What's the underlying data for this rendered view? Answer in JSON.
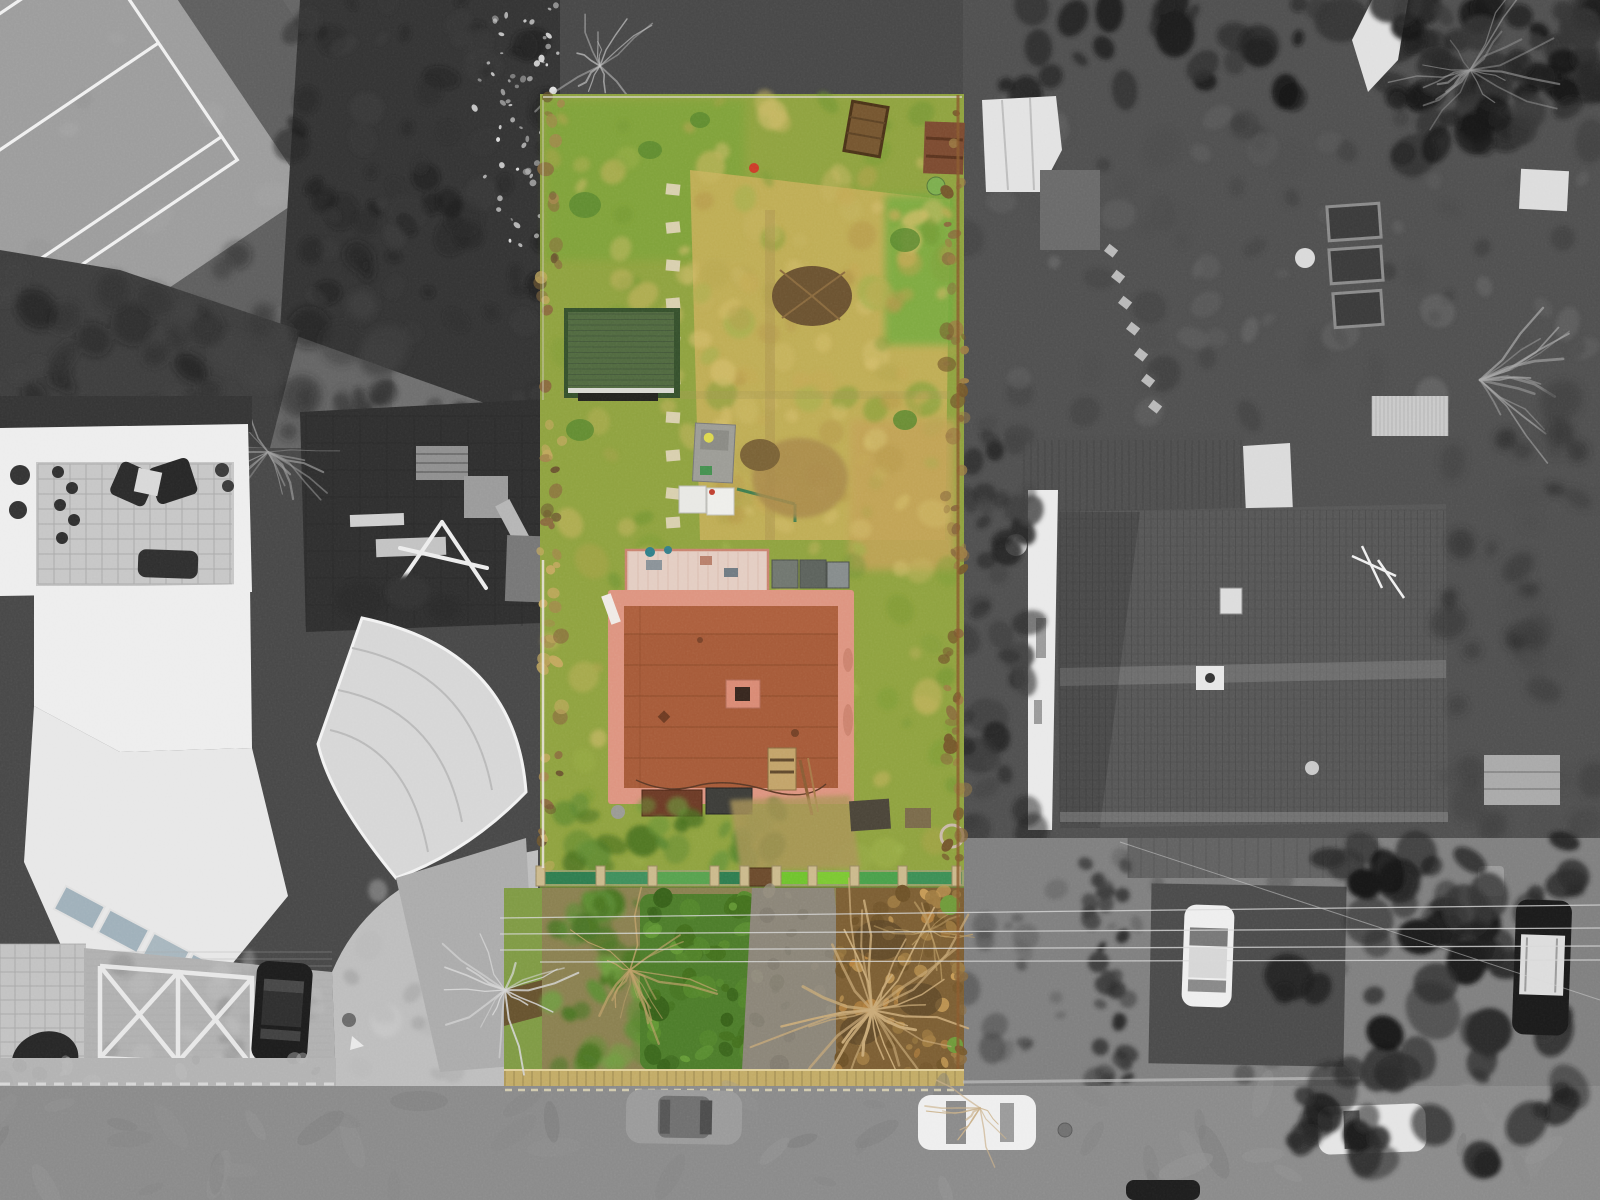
{
  "scene": {
    "type": "aerial-drone-photograph",
    "description": "Top-down aerial photo of a residential plot highlighted in colour while the surrounding neighbourhood is desaturated black-and-white",
    "regions": {
      "tennis_court": "tennis court, top left, grayscale",
      "gray_path": "footpath strip left of the parcel",
      "playground": "playground with dark rubber surface and swing frame",
      "left_building": "white modern apartment building with roof terrace",
      "canopy": "curved fan-shaped white canopy roof",
      "forecourt": "brick forecourt with white X parking markings and black car",
      "highlighted_parcel": "colour-highlighted garden parcel with lawn, shed and flat-roof house",
      "garden_shed": "green-roofed garden shed",
      "flat_roof_house": "terracotta flat-roof house with pink parapet and chimney",
      "green_fence": "green garden fence crossing the parcel",
      "front_garden": "front garden with hedge, bare trees and path",
      "neighbour_roof": "large grey tiled hipped roof, right side",
      "street": "street along the bottom with parked cars",
      "side_street": "right-hand street with parked cars and large evergreen tree"
    }
  },
  "palette": {
    "bg": "#474747",
    "ground_gray": "#646464",
    "path_gray": "#6e6e6e",
    "dark_veg": "#343434",
    "court_apron": "#5e5e5e",
    "court_surface": "#9c9c9c",
    "court_line": "#f0f0f0",
    "playground": "#2e2e2e",
    "building_white": "#ededed",
    "terrace_tile": "#c6c6c6",
    "furniture_dark": "#2a2a2a",
    "brick_pale": "#b0b0b0",
    "marking_white": "#ececec",
    "canopy": "#d6d6d6",
    "walkway": "#ababab",
    "ramp": "#bdbdbd",
    "road": "#8a8a8a",
    "sidewalk": "#b2b2b2",
    "car_gray": "#9a9a9a",
    "car_white": "#eeeeee",
    "car_black": "#1c1c1c",
    "roof_tile_gray": "#565656",
    "gable_white": "#e9e9e9",
    "tarp_white": "#dadada",
    "shed_white_roof": "#e2e2e2",
    "parcel_grass": "#8fa23f",
    "grass_bright": "#7aa338",
    "meadow_dry": "#c4ae58",
    "patch_tan": "#c2a257",
    "shed_roof": "#50693f",
    "shed_eave": "#d9d9d2",
    "house_roof": "#a65a38",
    "roof_border": "#dd9480",
    "chimney": "#d98a74",
    "pergola": "#e3cdc2",
    "rust_panel": "#6c3a26",
    "dark_panel": "#3c3c38",
    "fence_green_dark": "#2e7d4f",
    "fence_green_bright": "#6fc32d",
    "fence_post": "#cbb98c",
    "hedge_front": "#4c7c2a",
    "front_brown": "#7c5e33",
    "front_path": "#8b8578",
    "curb_yellow": "#c2ab66",
    "boundary_brown": "#7a6038",
    "branch_tan": "#c9aa78",
    "red_accent": "#cc3b28",
    "tank_white": "#e8e8e4",
    "stone_path": "#d8cfae",
    "powerline": "#d8d8d8"
  },
  "textures": [
    {
      "target": "tx-topdark",
      "x": 290,
      "y": 0,
      "w": 265,
      "h": 335,
      "n": 70,
      "rmin": 6,
      "rmax": 20,
      "colors": [
        "#262626",
        "#383838",
        "#1c1c1c"
      ],
      "op": 0.5,
      "seed": 11
    },
    {
      "target": "tx-speckwhite",
      "x": 468,
      "y": 0,
      "w": 92,
      "h": 250,
      "n": 60,
      "rmin": 1.5,
      "rmax": 4,
      "colors": [
        "#d2d2d2",
        "#e6e6e6",
        "#bfbfbf"
      ],
      "op": 0.75,
      "seed": 12
    },
    {
      "target": "tx-graypath",
      "x": 392,
      "y": 0,
      "w": 160,
      "h": 436,
      "n": 45,
      "rmin": 4,
      "rmax": 13,
      "colors": [
        "#636363",
        "#7b7b7b",
        "#8c8c8c"
      ],
      "op": 0.5,
      "seed": 13
    },
    {
      "target": "tx-leftdark",
      "x": 0,
      "y": 255,
      "w": 400,
      "h": 185,
      "n": 55,
      "rmin": 8,
      "rmax": 22,
      "colors": [
        "#2c2c2c",
        "#404040",
        "#1f1f1f"
      ],
      "op": 0.55,
      "seed": 14
    },
    {
      "target": "tx-treesoverplay",
      "x": 300,
      "y": 392,
      "w": 270,
      "h": 62,
      "n": 25,
      "rmin": 6,
      "rmax": 16,
      "colors": [
        "#2a2a2a",
        "#3c3c3c"
      ],
      "op": 0.6,
      "seed": 15
    },
    {
      "target": "tx-court",
      "x": -240,
      "y": -160,
      "w": 520,
      "h": 380,
      "n": 25,
      "rmin": 8,
      "rmax": 18,
      "colors": [
        "#8f8f8f",
        "#a8a8a8"
      ],
      "op": 0.3,
      "seed": 16
    },
    {
      "target": "tx-forecourt",
      "x": 90,
      "y": 955,
      "w": 235,
      "h": 125,
      "n": 30,
      "rmin": 6,
      "rmax": 14,
      "colors": [
        "#bcbcbc",
        "#9f9f9f",
        "#8f8f8f"
      ],
      "op": 0.5,
      "seed": 17
    },
    {
      "target": "tx-ramp",
      "x": 340,
      "y": 860,
      "w": 180,
      "h": 220,
      "n": 25,
      "rmin": 6,
      "rmax": 16,
      "colors": [
        "#b5b5b5",
        "#c8c8c8",
        "#a0a0a0"
      ],
      "op": 0.5,
      "seed": 18
    },
    {
      "target": "tx-sidewalkbl",
      "x": 0,
      "y": 1058,
      "w": 340,
      "h": 26,
      "n": 12,
      "rmin": 4,
      "rmax": 10,
      "colors": [
        "#bababa",
        "#a8a8a8"
      ],
      "op": 0.5,
      "seed": 19
    },
    {
      "target": "tx-parcelgrass",
      "x": 548,
      "y": 100,
      "w": 410,
      "h": 760,
      "n": 170,
      "rmin": 5,
      "rmax": 17,
      "colors": [
        "#9db04a",
        "#7d9c36",
        "#c6b45f",
        "#b2a24c",
        "#6e9330",
        "#d0bc6a"
      ],
      "op": 0.5,
      "seed": 21
    },
    {
      "target": "tx-dryextra",
      "x": 700,
      "y": 190,
      "w": 250,
      "h": 340,
      "n": 60,
      "rmin": 6,
      "rmax": 15,
      "colors": [
        "#d2bc68",
        "#c3a954",
        "#b5974a"
      ],
      "op": 0.6,
      "seed": 22
    },
    {
      "target": "tx-lowershrub",
      "x": 560,
      "y": 800,
      "w": 220,
      "h": 80,
      "n": 30,
      "rmin": 6,
      "rmax": 16,
      "colors": [
        "#55842e",
        "#6a9438",
        "#47701f"
      ],
      "op": 0.7,
      "seed": 23
    },
    {
      "target": "tx-frontgreen",
      "x": 548,
      "y": 892,
      "w": 100,
      "h": 180,
      "n": 40,
      "rmin": 6,
      "rmax": 16,
      "colors": [
        "#5d8c33",
        "#4a7524",
        "#6f9e3f"
      ],
      "op": 0.8,
      "seed": 24
    },
    {
      "target": "tx-hedgecol",
      "x": 642,
      "y": 896,
      "w": 110,
      "h": 172,
      "n": 50,
      "rmin": 4,
      "rmax": 12,
      "colors": [
        "#426f1d",
        "#55882c",
        "#37611a",
        "#649a36"
      ],
      "op": 0.8,
      "seed": 25
    },
    {
      "target": "tx-frontbrown",
      "x": 838,
      "y": 890,
      "w": 122,
      "h": 182,
      "n": 70,
      "rmin": 3,
      "rmax": 8,
      "colors": [
        "#a07c42",
        "#b5823f",
        "#6e5228",
        "#c59a55"
      ],
      "op": 0.8,
      "seed": 26
    },
    {
      "target": "tx-pathfront",
      "x": 748,
      "y": 890,
      "w": 100,
      "h": 182,
      "n": 18,
      "rmin": 4,
      "rmax": 10,
      "colors": [
        "#7f7a6d",
        "#968f80"
      ],
      "op": 0.6,
      "seed": 27
    },
    {
      "target": "tx-leftbound",
      "x": 540,
      "y": 96,
      "w": 22,
      "h": 772,
      "n": 60,
      "rmin": 3,
      "rmax": 8,
      "colors": [
        "#8a6b3e",
        "#a3864c",
        "#c2a85e",
        "#6b5530"
      ],
      "op": 0.8,
      "seed": 28
    },
    {
      "target": "tx-rightbound",
      "x": 944,
      "y": 96,
      "w": 20,
      "h": 975,
      "n": 70,
      "rmin": 3,
      "rmax": 8,
      "colors": [
        "#8a6b3e",
        "#9c7c44",
        "#75582c"
      ],
      "op": 0.8,
      "seed": 29
    },
    {
      "target": "tx-hedgerowtop",
      "x": 963,
      "y": 0,
      "w": 637,
      "h": 100,
      "n": 60,
      "rmin": 8,
      "rmax": 24,
      "colors": [
        "#1e1e1e",
        "#2d2d2d",
        "#141414"
      ],
      "op": 0.8,
      "seed": 31
    },
    {
      "target": "tx-rightground",
      "x": 963,
      "y": 100,
      "w": 630,
      "h": 325,
      "n": 90,
      "rmin": 6,
      "rmax": 18,
      "colors": [
        "#4b4b4b",
        "#5d5d5d",
        "#3b3b3b",
        "#6a6a6a"
      ],
      "op": 0.55,
      "seed": 32
    },
    {
      "target": "tx-trcorner",
      "x": 1380,
      "y": 0,
      "w": 220,
      "h": 170,
      "n": 40,
      "rmin": 8,
      "rmax": 22,
      "colors": [
        "#222222",
        "#333333",
        "#181818"
      ],
      "op": 0.7,
      "seed": 33
    },
    {
      "target": "tx-bushesmid",
      "x": 963,
      "y": 420,
      "w": 70,
      "h": 430,
      "n": 40,
      "rmin": 8,
      "rmax": 18,
      "colors": [
        "#303030",
        "#414141",
        "#232323"
      ],
      "op": 0.7,
      "seed": 34
    },
    {
      "target": "tx-rightgardenlow",
      "x": 1448,
      "y": 400,
      "w": 152,
      "h": 440,
      "n": 40,
      "rmin": 8,
      "rmax": 20,
      "colors": [
        "#3a3a3a",
        "#2b2b2b",
        "#4a4a4a"
      ],
      "op": 0.6,
      "seed": 35
    },
    {
      "target": "tx-rightstreet",
      "x": 963,
      "y": 845,
      "w": 380,
      "h": 230,
      "n": 45,
      "rmin": 5,
      "rmax": 14,
      "colors": [
        "#474747",
        "#585858",
        "#3a3a3a"
      ],
      "op": 0.5,
      "seed": 36
    },
    {
      "target": "tx-hedgestreet",
      "x": 1085,
      "y": 855,
      "w": 45,
      "h": 225,
      "n": 30,
      "rmin": 6,
      "rmax": 12,
      "colors": [
        "#2d2d2d",
        "#3c3c3c"
      ],
      "op": 0.8,
      "seed": 37
    },
    {
      "target": "tx-road",
      "x": 0,
      "y": 1090,
      "w": 1600,
      "h": 106,
      "n": 55,
      "rmin": 10,
      "rmax": 30,
      "colors": [
        "#828282",
        "#959595",
        "#787878"
      ],
      "op": 0.35,
      "squash": 0.35,
      "seed": 38
    },
    {
      "target": "tx-rightsidewalk",
      "x": 1340,
      "y": 1086,
      "w": 260,
      "h": 112,
      "n": 20,
      "rmin": 8,
      "rmax": 20,
      "colors": [
        "#a5a5a5",
        "#909090"
      ],
      "op": 0.5,
      "seed": 39
    },
    {
      "target": "tx-canopytree",
      "x": 1285,
      "y": 835,
      "w": 295,
      "h": 330,
      "n": 80,
      "rmin": 8,
      "rmax": 26,
      "colors": [
        "#1d1d1d",
        "#2a2a2a",
        "#151515",
        "#333333"
      ],
      "op": 0.85,
      "seed": 41
    }
  ],
  "grids": [
    {
      "target": "gr-playgrid",
      "x": 306,
      "y": 416,
      "w": 258,
      "h": 210,
      "stepX": 27,
      "stepY": 27,
      "stroke": "#242424",
      "width": 1,
      "opacity": 0.5
    },
    {
      "target": "gr-terrace",
      "x": 38,
      "y": 464,
      "w": 194,
      "h": 120,
      "stepX": 16,
      "stepY": 15,
      "stroke": "#a2a2a2",
      "width": 1,
      "opacity": 0.8
    },
    {
      "target": "gr-terr2",
      "x": 0,
      "y": 944,
      "w": 86,
      "h": 142,
      "stepX": 15,
      "stepY": 14,
      "stroke": "#9e9e9e",
      "width": 1,
      "opacity": 0.7
    },
    {
      "target": "gr-brick",
      "x": 86,
      "y": 952,
      "w": 246,
      "h": 130,
      "stepY": 7,
      "stroke": "#a6a6a6",
      "width": 0.7,
      "opacity": 0.5
    },
    {
      "target": "gr-shed",
      "x": 568,
      "y": 314,
      "w": 106,
      "h": 74,
      "stepY": 5.5,
      "stroke": "#42583a",
      "width": 1,
      "opacity": 0.9
    },
    {
      "target": "gr-pergola",
      "x": 628,
      "y": 552,
      "w": 138,
      "h": 40,
      "stepX": 10,
      "stroke": "#d0aa9c",
      "width": 0.8,
      "opacity": 0.6
    },
    {
      "target": "gr-roofseams",
      "x": 624,
      "y": 634,
      "w": 214,
      "h": 150,
      "stepY": 31,
      "stroke": "#8f4b2c",
      "width": 1.3,
      "opacity": 0.8
    },
    {
      "target": "gr-curb",
      "x": 505,
      "y": 1071,
      "w": 458,
      "h": 16,
      "stepX": 9,
      "stroke": "#8a7746",
      "width": 1,
      "opacity": 0.7
    },
    {
      "target": "gr-toproof",
      "x": 1024,
      "y": 440,
      "w": 220,
      "h": 72,
      "stepX": 7,
      "stroke": "#3a3a3a",
      "width": 0.8,
      "opacity": 0.6
    },
    {
      "target": "gr-bigroof",
      "x": 1060,
      "y": 510,
      "w": 386,
      "h": 314,
      "stepX": 6.5,
      "stroke": "#3f3f3f",
      "width": 0.8,
      "opacity": 0.55
    },
    {
      "target": "gr-bigroof",
      "x": 1060,
      "y": 510,
      "w": 386,
      "h": 314,
      "stepY": 9,
      "stroke": "#494949",
      "width": 0.8,
      "opacity": 0.5
    },
    {
      "target": "gr-corrug",
      "x": 1372,
      "y": 396,
      "w": 76,
      "h": 40,
      "stepX": 4,
      "stroke": "#a8a8a8",
      "width": 0.8,
      "opacity": 0.8
    },
    {
      "target": "gr-wallbrick",
      "x": 1128,
      "y": 838,
      "w": 250,
      "h": 40,
      "stepX": 13,
      "stroke": "#4e4e4e",
      "width": 0.8,
      "opacity": 0.7
    }
  ],
  "branches": [
    {
      "target": "br-play",
      "cx": 268,
      "cy": 452,
      "n": 16,
      "amin": 0,
      "amax": 360,
      "lmin": 30,
      "lmax": 85,
      "stroke": "#9f9f9f",
      "width": 1.6,
      "op": 0.6,
      "seed": 51
    },
    {
      "target": "br-parceltop",
      "cx": 600,
      "cy": 66,
      "n": 12,
      "amin": 0,
      "amax": 360,
      "lmin": 25,
      "lmax": 80,
      "stroke": "#c4c4c4",
      "width": 1.5,
      "op": 0.6,
      "seed": 52
    },
    {
      "target": "br-right",
      "cx": 1470,
      "cy": 70,
      "n": 18,
      "amin": 0,
      "amax": 360,
      "lmin": 30,
      "lmax": 100,
      "stroke": "#9a9a9a",
      "width": 1.6,
      "op": 0.55,
      "seed": 53
    },
    {
      "target": "br-pile",
      "cx": 1480,
      "cy": 380,
      "n": 14,
      "amin": -40,
      "amax": 50,
      "lmin": 40,
      "lmax": 110,
      "stroke": "#a8a8a8",
      "width": 2,
      "op": 0.6,
      "seed": 54
    },
    {
      "target": "br-front",
      "cx": 872,
      "cy": 1010,
      "n": 30,
      "amin": 0,
      "amax": 360,
      "lmin": 40,
      "lmax": 140,
      "stroke": "#c9aa78",
      "width": 2.2,
      "op": 0.85,
      "seed": 55
    },
    {
      "target": "br-front",
      "cx": 630,
      "cy": 970,
      "n": 18,
      "amin": 0,
      "amax": 360,
      "lmin": 30,
      "lmax": 90,
      "stroke": "#bfa069",
      "width": 1.8,
      "op": 0.7,
      "seed": 56
    },
    {
      "target": "br-front",
      "cx": 930,
      "cy": 930,
      "n": 12,
      "amin": 0,
      "amax": 360,
      "lmin": 20,
      "lmax": 60,
      "stroke": "#b99a62",
      "width": 1.5,
      "op": 0.7,
      "seed": 57
    },
    {
      "target": "br-road",
      "cx": 980,
      "cy": 1108,
      "n": 10,
      "amin": 0,
      "amax": 360,
      "lmin": 20,
      "lmax": 70,
      "stroke": "#c9b089",
      "width": 1.5,
      "op": 0.8,
      "seed": 58
    },
    {
      "target": "br-whitetree",
      "cx": 505,
      "cy": 990,
      "n": 16,
      "amin": 0,
      "amax": 360,
      "lmin": 30,
      "lmax": 90,
      "stroke": "#d6d6d6",
      "width": 1.8,
      "op": 0.8,
      "seed": 59
    }
  ]
}
